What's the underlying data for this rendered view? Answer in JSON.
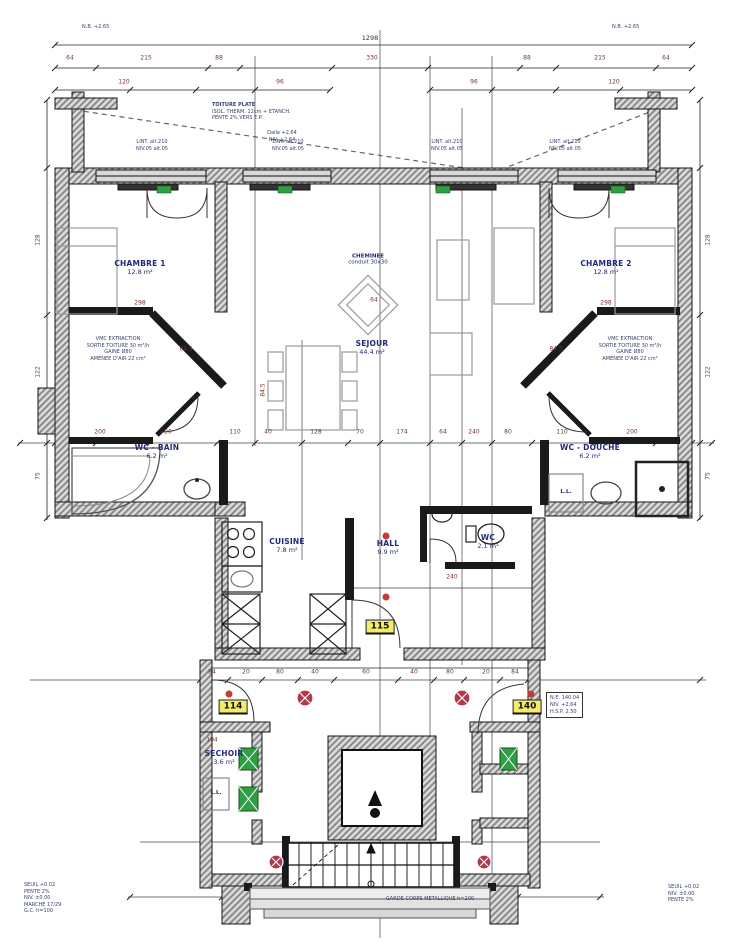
{
  "rooms": [
    {
      "name": "CHAMBRE 1",
      "area": "12.8 m²"
    },
    {
      "name": "CHAMBRE 2",
      "area": "12.8 m²"
    },
    {
      "name": "SEJOUR",
      "area": "44.4 m²"
    },
    {
      "name": "WC - BAIN",
      "area": "6.2 m²"
    },
    {
      "name": "WC - DOUCHE",
      "area": "6.2 m²"
    },
    {
      "name": "CUISINE",
      "area": "7.8 m²"
    },
    {
      "name": "HALL",
      "area": "9.9 m²"
    },
    {
      "name": "WC",
      "area": "2.1 m²"
    },
    {
      "name": "SECHOIR",
      "area": "3.6 m²"
    }
  ],
  "tags": {
    "left": "114",
    "hall": "115",
    "right": "140"
  },
  "labels": {
    "cheminee_1": "CHEMINEE",
    "cheminee_2": "conduit 30x30",
    "nb": "N.B. +2.65",
    "lintel_1": "LINT. alt.210",
    "lintel_2": "NIV.05 alt.05",
    "ll": "L.L.",
    "note_top_1": "TOITURE PLATE",
    "note_top_2": "ISOL. THERM. 12cm + ETANCH.",
    "note_top_3": "PENTE 2% VERS E.P.",
    "dalle_1": "Dalle +2.64",
    "dalle_2": "NIV. +2.64",
    "vmc_1": "VMC EXTRACTION",
    "vmc_2": "SORTIE TOITURE 30 m³/h",
    "vmc_3": "GAINE Ø80",
    "vmc_4": "AMENEE D'AIR 22 cm²",
    "box_1": "N.E. 140.04",
    "box_2": "NIV. +2.64",
    "box_3": "H.S.P. 2.50",
    "bl_1": "SEUIL +0.02",
    "bl_2": "PENTE 2%",
    "bl_3": "NIV. ±0.00",
    "bl_4": "MARCHE 17/29",
    "bl_5": "G.C. h=100",
    "br_1": "SEUIL +0.02",
    "br_2": "NIV. ±0.00",
    "br_3": "PENTE 2%",
    "bc": "GARDE-CORPS METALLIQUE h=100"
  },
  "dims": {
    "overall": "1298",
    "top": [
      "64",
      "215",
      "88",
      "330",
      "88",
      "215",
      "64"
    ],
    "top2": [
      "120",
      "96",
      "96",
      "120"
    ],
    "mid": [
      "200",
      "90",
      "110",
      "40",
      "128",
      "70",
      "174",
      "64",
      "240",
      "80",
      "110",
      "200"
    ],
    "bottom": [
      "84",
      "20",
      "80",
      "40",
      "60",
      "40",
      "80",
      "20",
      "84"
    ],
    "left": [
      "128",
      "122",
      "75"
    ],
    "right": [
      "128",
      "122",
      "75"
    ],
    "ch1": "298",
    "ch2": "298",
    "d845a": "84.5",
    "d845b": "84.5",
    "d845c": "84.5",
    "n240": "240",
    "n64": "64",
    "n104": "104"
  }
}
